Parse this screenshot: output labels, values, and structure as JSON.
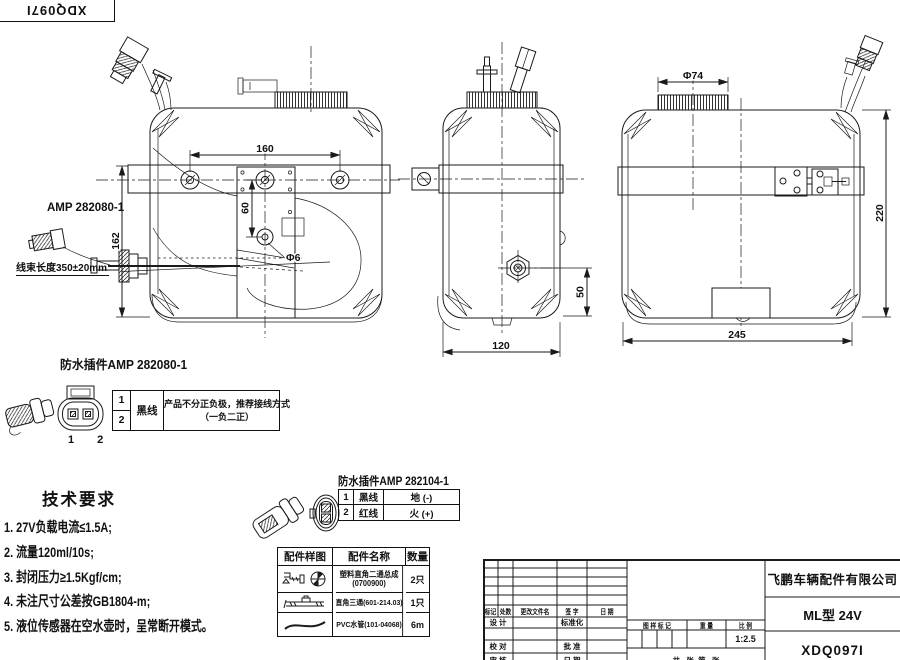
{
  "doc_box": {
    "number": "XDQ097I"
  },
  "drawing": {
    "front_view": {
      "amp_label": "AMP 282080-1",
      "harness_note": "线束长度350±20mm",
      "dim_hole_spacing": "160",
      "dim_vertical": "60",
      "dim_hole": "Φ6",
      "dim_height": "162"
    },
    "side_view": {
      "dim_sensor_height": "50",
      "dim_width": "120"
    },
    "rear_view": {
      "dim_cap": "Φ74",
      "dim_height": "220",
      "dim_width": "245"
    }
  },
  "connector1": {
    "title": "防水插件AMP 282080-1",
    "pins": "1 2",
    "rows": [
      "1",
      "2"
    ],
    "wire": "黑线",
    "note_line1": "产品不分正负极，推荐接线方式",
    "note_line2": "（一负二正）"
  },
  "tech": {
    "title": "技术要求",
    "items": [
      "1. 27V负载电流≤1.5A;",
      "2. 流量120ml/10s;",
      "3. 封闭压力≥1.5Kgf/cm;",
      "4. 未注尺寸公差按GB1804-m;",
      "5. 液位传感器在空水壶时，呈常断开模式。"
    ]
  },
  "connector2": {
    "title": "防水插件AMP 282104-1",
    "rows": [
      {
        "no": "1",
        "wire": "黑线",
        "pole": "地 (-)"
      },
      {
        "no": "2",
        "wire": "红线",
        "pole": "火 (+)"
      }
    ]
  },
  "parts_table": {
    "headers": [
      "配件样图",
      "配件名称",
      "数量"
    ],
    "rows": [
      {
        "name": "塑料直角二通总成",
        "code": "(0700900)",
        "qty": "2只"
      },
      {
        "name": "直角三通(601-214.03)",
        "code": "",
        "qty": "1只"
      },
      {
        "name": "PVC水管(101-04068)",
        "code": "",
        "qty": "6m"
      }
    ]
  },
  "title_block": {
    "company": "飞鹏车辆配件有限公司",
    "model": "ML型 24V",
    "drawing_no": "XDQ097I",
    "scale_value": "1:2.5",
    "rev_headers": [
      "标记",
      "处数",
      "更改文件名",
      "签 字",
      "日 期"
    ],
    "design": "设 计",
    "standardize": "标准化",
    "check": "校 对",
    "approve": "批 准",
    "audit": "审 核",
    "date": "日 期",
    "mark_header": "图 样 标 记",
    "weight_header": "重 量",
    "scale_header": "比 例",
    "sheet_note": "共   张  第   张"
  }
}
